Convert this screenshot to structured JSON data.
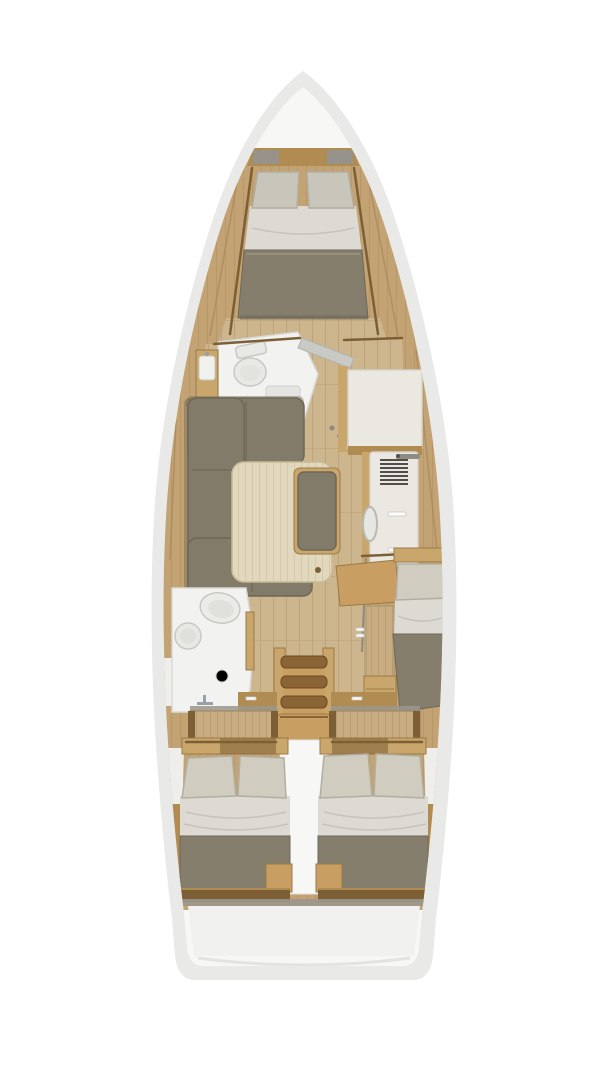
{
  "page": {
    "background": "#ffffff",
    "description": "Top-down rendered interior layout plan of a sailing yacht, no visible text"
  },
  "palette": {
    "bg": "#ffffff",
    "hull_outer": "#e9e9e7",
    "deck": "#f7f7f5",
    "deck_wood": "#c3a273",
    "deck_wood_line": "#aa8b5b",
    "floor_wood": "#cdb58d",
    "floor_line": "#b99f74",
    "wood_dark": "#7d5f36",
    "wood_mid": "#b08c52",
    "wood_light": "#c9a76c",
    "cabinet_wood": "#c8ad83",
    "cabinet_line": "#b2966a",
    "step_tread": "#8a6434",
    "step_tread_edge": "#6b4a24",
    "step_riser": "#c89e62",
    "table": "#e2d8be",
    "table_line": "#d2c6a6",
    "sofa": "#837b69",
    "sofa_dark": "#6e6757",
    "blanket": "#867e6c",
    "sheet": "#dcdad3",
    "sheet_line": "#c4c1b8",
    "pillow": "#d0ccbf",
    "pillow_grey": "#c8c5bb",
    "pillow_line": "#b2ae9f",
    "room_white": "#f2f2f0",
    "room_line": "#d9d9d5",
    "fixture": "#e8e8e4",
    "fixture_line": "#c8c8c4",
    "cream": "#eae8e1",
    "cream_line": "#d5d2c9",
    "grille": "#514f4a",
    "door_grey": "#c9c9c5",
    "door_grey_line": "#b2b2ae",
    "grey_sill": "#9b978e",
    "metal": "#9aa0a8",
    "transom": "#f1f1ef",
    "transom_line": "#e3e3e1",
    "handle_white": "#fcfcfa",
    "liner_white": "#efeeea"
  },
  "floorplan": {
    "type": "sailboat-interior-top-down-plan",
    "areas": [
      {
        "name": "bow-deck",
        "features": [
          "hull-outline",
          "anchor-shelf"
        ]
      },
      {
        "name": "forward-cabin",
        "features": [
          "v-berth-bed",
          "two-pillows",
          "foot-cushion",
          "side-shelves"
        ]
      },
      {
        "name": "forward-head",
        "features": [
          "toilet",
          "shower-pan",
          "vanity-sink",
          "open-door"
        ]
      },
      {
        "name": "starboard-lockers",
        "features": [
          "wardrobe-cabinet",
          "galley-unit",
          "vent-grille",
          "galley-sink"
        ]
      },
      {
        "name": "salon",
        "features": [
          "u-shaped-sofa",
          "wood-table",
          "side-bench"
        ]
      },
      {
        "name": "aft-head",
        "features": [
          "toilet",
          "round-sink",
          "faucet",
          "floor-drain"
        ]
      },
      {
        "name": "mid-cabin-starboard",
        "features": [
          "single-berth",
          "pillow",
          "blanket",
          "step-cabinet",
          "drawer-chest"
        ]
      },
      {
        "name": "companionway",
        "features": [
          "four-steps",
          "side-rails",
          "landing-platform"
        ]
      },
      {
        "name": "aft-cabin-port",
        "features": [
          "double-bed",
          "two-pillows",
          "blanket",
          "corner-step"
        ]
      },
      {
        "name": "aft-cabin-starboard",
        "features": [
          "double-bed",
          "two-pillows",
          "blanket",
          "corner-step"
        ]
      },
      {
        "name": "stern",
        "features": [
          "hull-step-band",
          "transom-panel"
        ]
      }
    ]
  }
}
